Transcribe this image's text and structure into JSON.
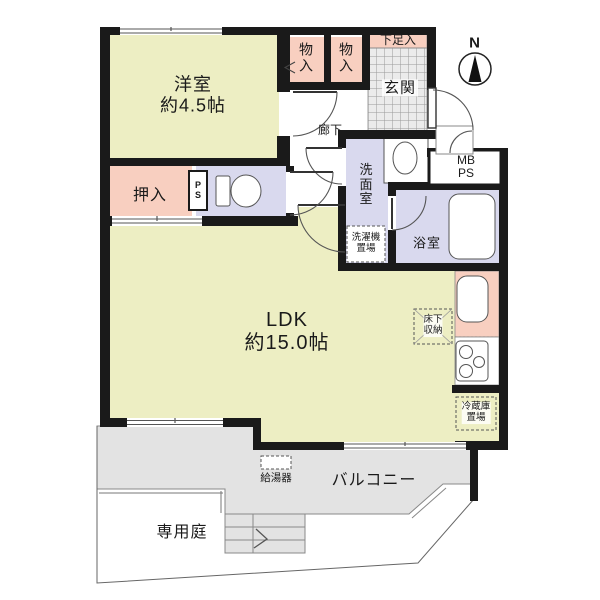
{
  "plan": {
    "compass_label": "N",
    "rooms": {
      "western_room": {
        "name": "洋室",
        "size": "約4.5帖"
      },
      "ldk": {
        "name": "LDK",
        "size": "約15.0帖"
      },
      "closet": "押入",
      "storage_1": "物入",
      "storage_2": "物入",
      "shoe_box": "下足入",
      "entrance": "玄関",
      "hallway": "廊下",
      "washroom": "洗面室",
      "bathroom": "浴室",
      "balcony": "バルコニー",
      "private_garden": "専用庭"
    },
    "annotations": {
      "pipe_shaft_small": "PS",
      "meter_pipe_shaft": {
        "line1": "MB",
        "line2": "PS"
      },
      "washer_space": {
        "line1": "洗濯機",
        "line2": "置場"
      },
      "underfloor_storage": {
        "line1": "床下",
        "line2": "収納"
      },
      "refrigerator_space": {
        "line1": "冷蔵庫",
        "line2": "置場"
      },
      "water_heater": "給湯器"
    },
    "colors": {
      "wall": "#1a1a1a",
      "room_yellow": "#edeec3",
      "closet_pink": "#f8cfc0",
      "wet_area_lavender": "#d9d9ee",
      "balcony_gray": "#e3e3e3",
      "entrance_tile_bg": "#ebebeb",
      "entrance_tile_line": "#9a9a9a",
      "thin_line": "#666666"
    }
  }
}
